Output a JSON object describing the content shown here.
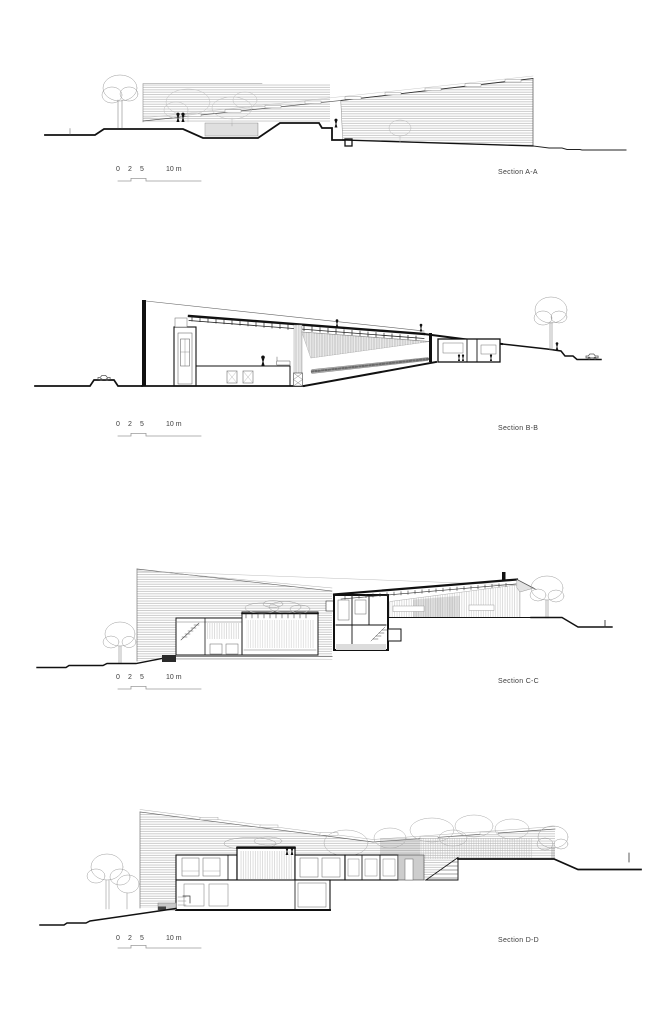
{
  "page": {
    "background": "#ffffff"
  },
  "sections": [
    {
      "id": "A",
      "label": "Section A-A",
      "scale_labels": [
        "0",
        "2",
        "5",
        "10 m"
      ]
    },
    {
      "id": "B",
      "label": "Section B-B",
      "scale_labels": [
        "0",
        "2",
        "5",
        "10 m"
      ]
    },
    {
      "id": "C",
      "label": "Section C-C",
      "scale_labels": [
        "0",
        "2",
        "5",
        "10 m"
      ]
    },
    {
      "id": "D",
      "label": "Section D-D",
      "scale_labels": [
        "0",
        "2",
        "5",
        "10 m"
      ]
    }
  ],
  "colors": {
    "line": "#1a1a1a",
    "hatch": "#9a9a9a",
    "sketch": "#b5b5b5",
    "grey_fill": "#d6d6d6",
    "text": "#3c3c3c"
  }
}
